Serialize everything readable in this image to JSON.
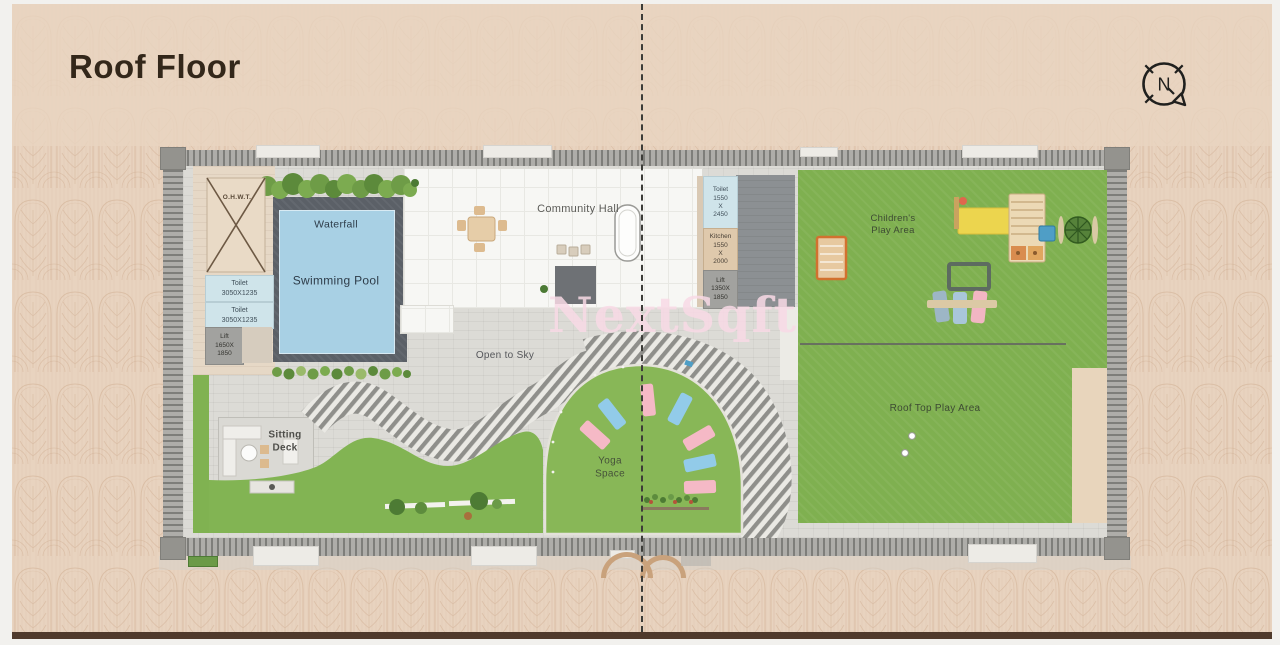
{
  "header": {
    "title": "Roof Floor",
    "compass_label": "N"
  },
  "watermark": {
    "text": "NextSqft"
  },
  "plan": {
    "areas": {
      "ohwt": "O.H.W.T.",
      "waterfall": "Waterfall",
      "swimming_pool": "Swimming Pool",
      "community_hall": "Community Hall",
      "open_to_sky": "Open to Sky",
      "sitting_deck_lines": [
        "Sitting",
        "Deck"
      ],
      "yoga_space_lines": [
        "Yoga",
        "Space"
      ],
      "childrens_play_lines": [
        "Children's",
        "Play Area"
      ],
      "roof_top_play": "Roof Top Play Area"
    },
    "rooms": {
      "toilet_left_1": {
        "lines": [
          "Toilet",
          "3050X1235"
        ]
      },
      "toilet_left_2": {
        "lines": [
          "Toilet",
          "3050X1235"
        ]
      },
      "lift_left": {
        "lines": [
          "Lift",
          "1650X",
          "1850"
        ]
      },
      "toilet_right": {
        "lines": [
          "Toilet",
          "1550",
          "X",
          "2450"
        ]
      },
      "kitchen": {
        "lines": [
          "Kitchen",
          "1550",
          "X",
          "2000"
        ]
      },
      "lift_right": {
        "lines": [
          "Lift",
          "1350X",
          "1850"
        ]
      }
    },
    "colors": {
      "background": "#e8d3bf",
      "lawn": "#7fb050",
      "pool": "#a8d0e4",
      "pool_deck": "#5b6067",
      "toilet_blue": "#cfe4ea",
      "kitchen_tan": "#dfc9ac",
      "lift_gray": "#a2a29f",
      "wall_gray": "#9a9a97",
      "mat_pink": "#f5b9c6",
      "mat_blue": "#92cbe9",
      "watermark_pink": "#f8d9e5",
      "bottom_bar": "#503a2c"
    }
  }
}
